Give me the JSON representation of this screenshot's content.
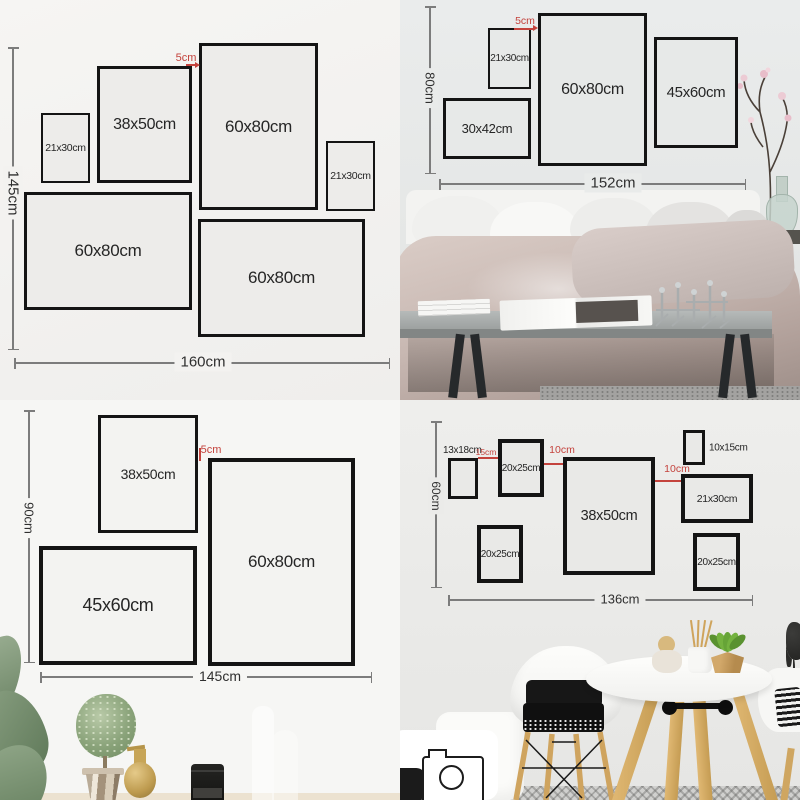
{
  "meta": {
    "title": "Gallery wall picture frame size guide with four layout examples"
  },
  "colors": {
    "accent_red": "#c4433d",
    "frame_border": "#141414",
    "dimension_line": "#7c7c7c",
    "label_text": "#262626",
    "wall_top_left": "#f3f2f0",
    "wall_top_right": "#e9ebea",
    "wall_bottom_left": "#f6f6f4",
    "wall_bottom_right": "#ebebe9"
  },
  "top_left": {
    "height_label": "145cm",
    "width_label": "160cm",
    "gap_label": "5cm",
    "frames": [
      {
        "label": "21x30cm",
        "x": 41,
        "y": 113,
        "w": 49,
        "h": 70,
        "bw": 2.5,
        "fs": 10.5
      },
      {
        "label": "38x50cm",
        "x": 97,
        "y": 66,
        "w": 95,
        "h": 117,
        "bw": 3.5,
        "fs": 16
      },
      {
        "label": "60x80cm",
        "x": 199,
        "y": 43,
        "w": 119,
        "h": 167,
        "bw": 3.5,
        "fs": 17
      },
      {
        "label": "21x30cm",
        "x": 326,
        "y": 141,
        "w": 49,
        "h": 70,
        "bw": 2.5,
        "fs": 10.5
      },
      {
        "label": "60x80cm",
        "x": 24,
        "y": 192,
        "w": 168,
        "h": 118,
        "bw": 3.5,
        "fs": 17
      },
      {
        "label": "60x80cm",
        "x": 198,
        "y": 219,
        "w": 167,
        "h": 118,
        "bw": 3.5,
        "fs": 17
      }
    ]
  },
  "top_right": {
    "height_label": "80cm",
    "width_label": "152cm",
    "gap_label": "5cm",
    "frames": [
      {
        "label": "21x30cm",
        "x": 88,
        "y": 28,
        "w": 43,
        "h": 61,
        "bw": 2.5,
        "fs": 10
      },
      {
        "label": "60x80cm",
        "x": 138,
        "y": 13,
        "w": 109,
        "h": 153,
        "bw": 3.5,
        "fs": 16
      },
      {
        "label": "45x60cm",
        "x": 254,
        "y": 37,
        "w": 84,
        "h": 111,
        "bw": 3,
        "fs": 15
      },
      {
        "label": "30x42cm",
        "x": 43,
        "y": 98,
        "w": 88,
        "h": 61,
        "bw": 3,
        "fs": 13
      }
    ]
  },
  "bottom_left": {
    "height_label": "90cm",
    "width_label": "145cm",
    "gap_label": "5cm",
    "frames": [
      {
        "label": "38x50cm",
        "x": 98,
        "y": 15,
        "w": 100,
        "h": 118,
        "bw": 3.5,
        "fs": 14
      },
      {
        "label": "60x80cm",
        "x": 208,
        "y": 58,
        "w": 147,
        "h": 208,
        "bw": 4.5,
        "fs": 17
      },
      {
        "label": "45x60cm",
        "x": 39,
        "y": 146,
        "w": 158,
        "h": 119,
        "bw": 4.5,
        "fs": 18
      }
    ]
  },
  "bottom_right": {
    "height_label": "60cm",
    "width_label": "136cm",
    "gaps": [
      {
        "label": "15cm"
      },
      {
        "label": "10cm"
      },
      {
        "label": "10cm"
      }
    ],
    "frames": [
      {
        "label": "13x18cm",
        "x": 48,
        "y": 58,
        "w": 30,
        "h": 41,
        "bw": 3,
        "fs": 10,
        "labelPos": "above"
      },
      {
        "label": "20x25cm",
        "x": 98,
        "y": 39,
        "w": 46,
        "h": 58,
        "bw": 4,
        "fs": 10
      },
      {
        "label": "38x50cm",
        "x": 163,
        "y": 57,
        "w": 92,
        "h": 118,
        "bw": 4,
        "fs": 14.5
      },
      {
        "label": "10x15cm",
        "x": 283,
        "y": 30,
        "w": 22,
        "h": 35,
        "bw": 3,
        "fs": 10,
        "labelPos": "right"
      },
      {
        "label": "21x30cm",
        "x": 281,
        "y": 74,
        "w": 72,
        "h": 49,
        "bw": 4,
        "fs": 10.5
      },
      {
        "label": "20x25cm",
        "x": 77,
        "y": 125,
        "w": 46,
        "h": 58,
        "bw": 4,
        "fs": 10
      },
      {
        "label": "20x25cm",
        "x": 293,
        "y": 133,
        "w": 47,
        "h": 58,
        "bw": 4,
        "fs": 10
      }
    ]
  }
}
